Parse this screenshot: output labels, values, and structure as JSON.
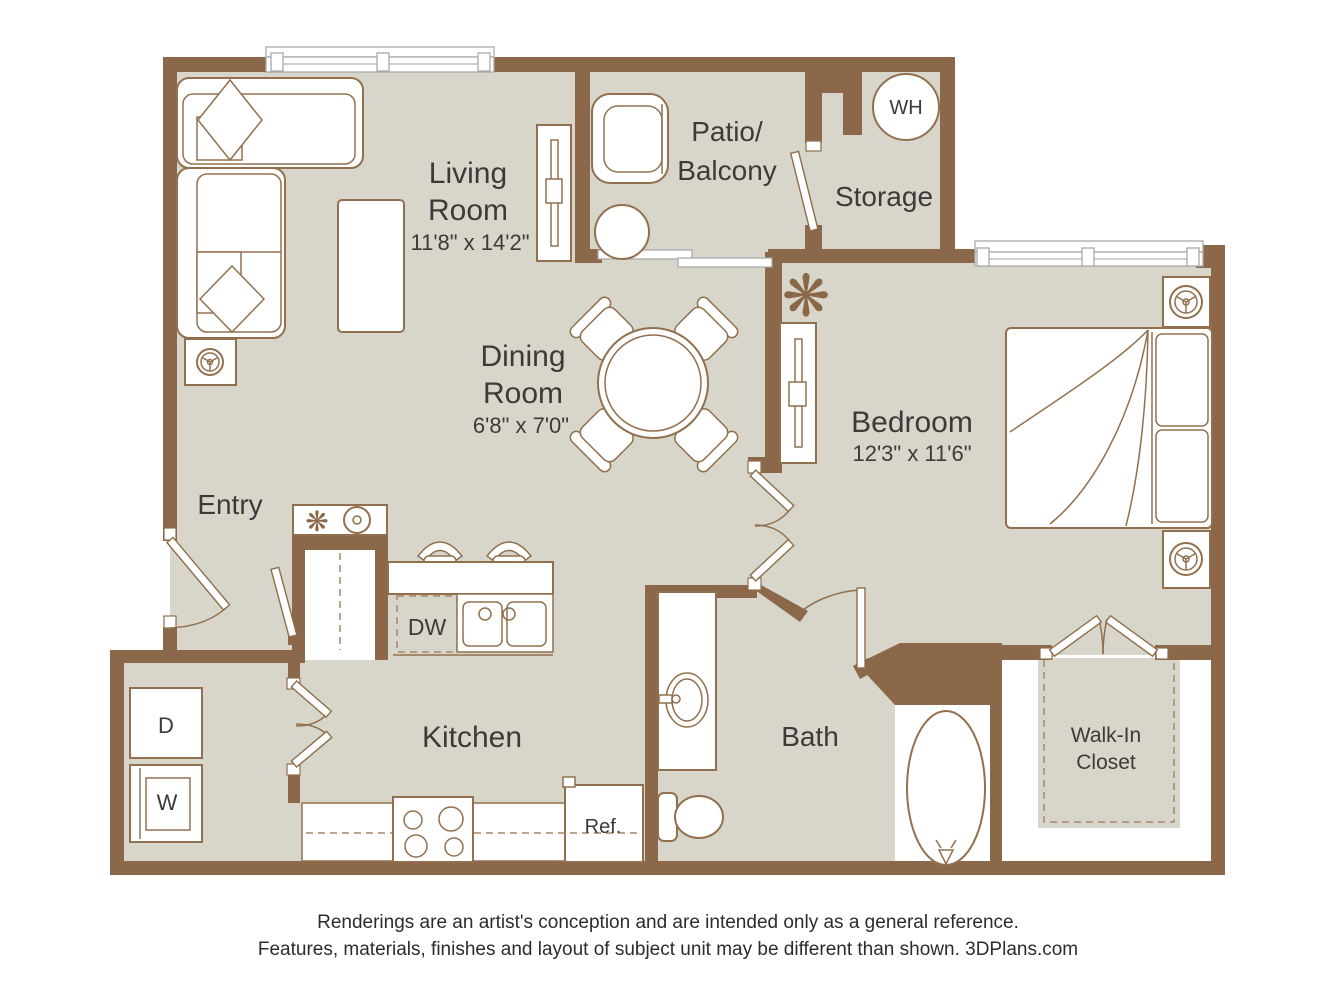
{
  "colors": {
    "wall": "#8b6849",
    "floor": "#d8d6ca",
    "furniture_line": "#92704e",
    "text": "#3c3b39",
    "dash": "#a5876a",
    "background": "#ffffff"
  },
  "rooms": {
    "living": {
      "line1": "Living",
      "line2": "Room",
      "dims": "11'8\" x 14'2\""
    },
    "dining": {
      "line1": "Dining",
      "line2": "Room",
      "dims": "6'8\" x 7'0\""
    },
    "bedroom": {
      "name": "Bedroom",
      "dims": "12'3\" x 11'6\""
    },
    "patio": {
      "line1": "Patio/",
      "line2": "Balcony"
    },
    "storage": {
      "name": "Storage"
    },
    "entry": {
      "name": "Entry"
    },
    "kitchen": {
      "name": "Kitchen"
    },
    "bath": {
      "name": "Bath"
    },
    "walk_in_closet": {
      "line1": "Walk-In",
      "line2": "Closet"
    }
  },
  "appliances": {
    "water_heater": "WH",
    "dishwasher": "DW",
    "refrigerator": "Ref.",
    "dryer": "D",
    "washer": "W"
  },
  "footer": {
    "line1": "Renderings are an artist's conception and are intended only as a general reference.",
    "line2": "Features, materials, finishes and layout of subject unit may be different than shown. 3DPlans.com"
  }
}
